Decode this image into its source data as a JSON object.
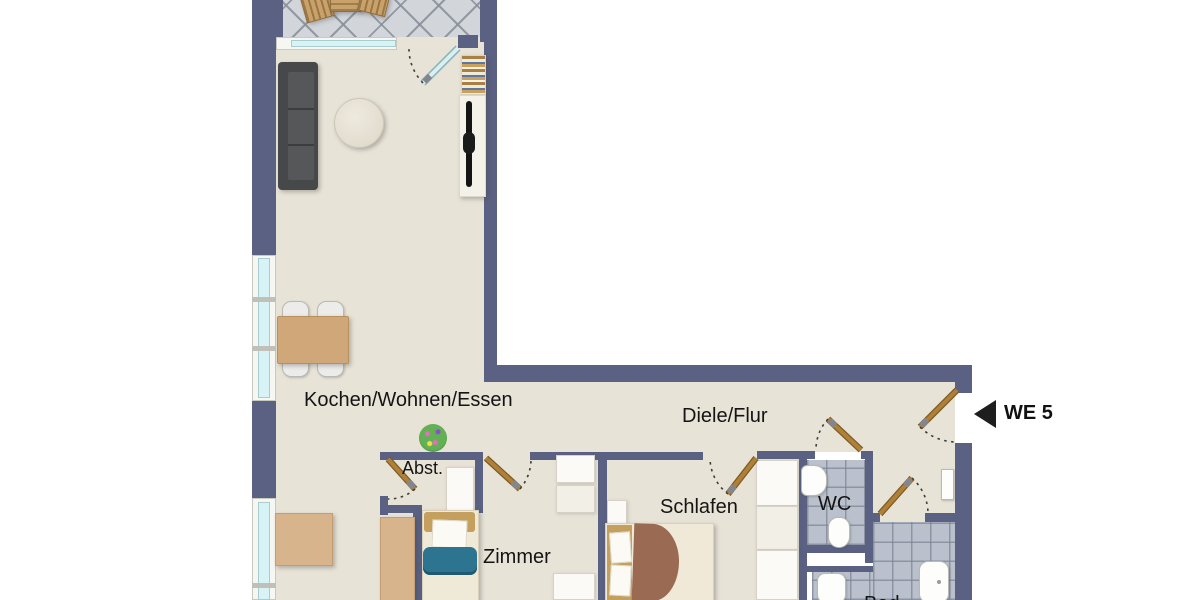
{
  "plan": {
    "type": "apartment-floor-plan",
    "unit_marker": {
      "label": "WE 5",
      "arrow_direction": "left"
    },
    "rooms": {
      "living": {
        "label": "Kochen/Wohnen/Essen"
      },
      "hall": {
        "label": "Diele/Flur"
      },
      "storage": {
        "label": "Abst."
      },
      "bedroom": {
        "label": "Schlafen"
      },
      "wc": {
        "label": "WC"
      },
      "room": {
        "label": "Zimmer"
      },
      "bath": {
        "label": "Bad"
      }
    },
    "colors": {
      "wall": "#5a6182",
      "floor": "#e8e3d7",
      "balcony_tile": "#d2d5da",
      "bath_tile": "#bac1cc",
      "window_glass": "#d8f3f5",
      "door_wood": "#a87a33",
      "sofa": "#47484a",
      "wood_furniture": "#cfa778",
      "blanket_teal": "#2c7490",
      "blanket_brown": "#9b6a52",
      "label_text": "#141414"
    }
  }
}
